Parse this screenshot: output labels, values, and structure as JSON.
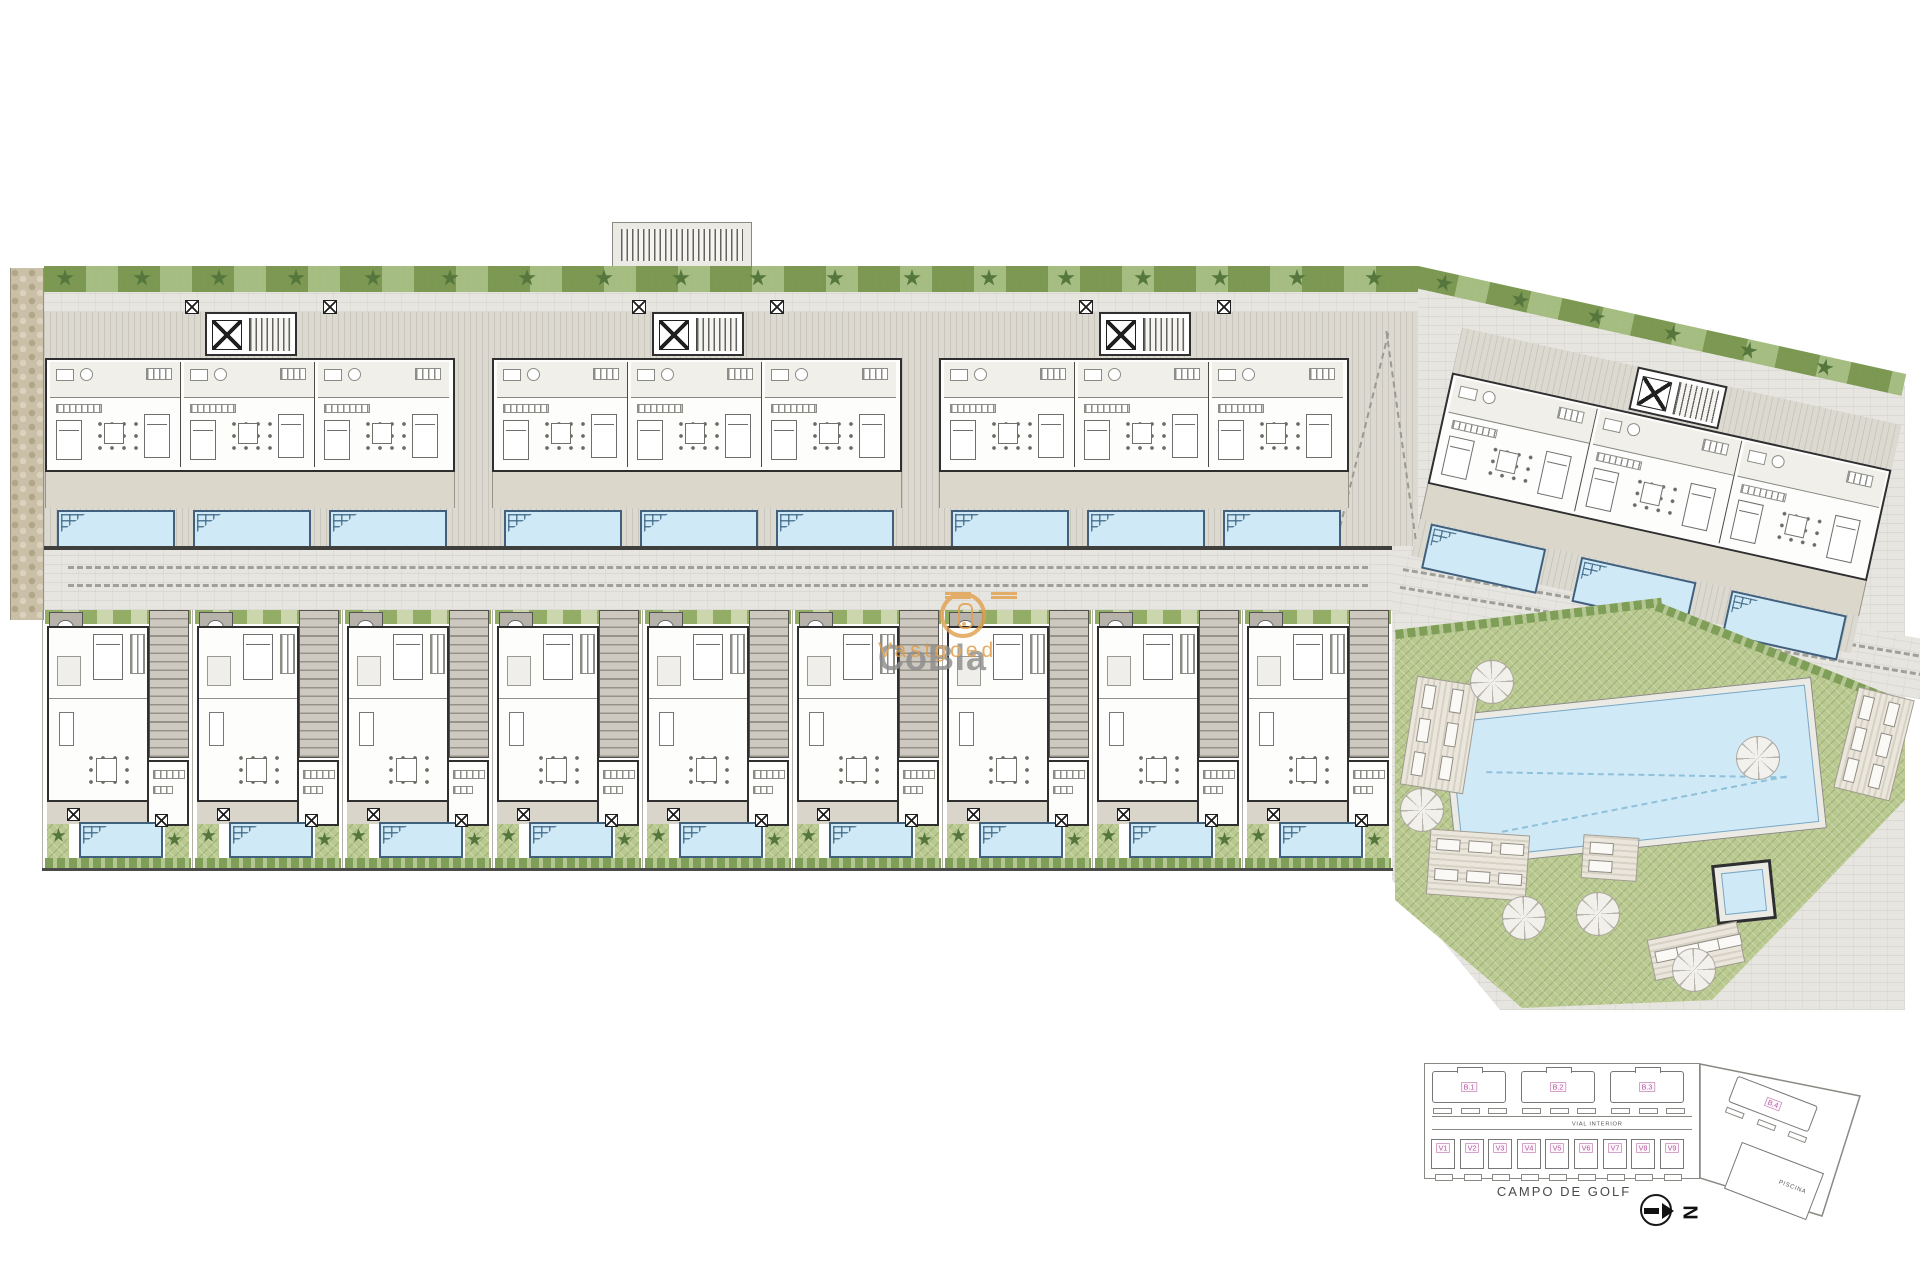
{
  "watermark": {
    "brand": "CoBla",
    "suffix": "Vastgoed",
    "brand_color": "#8d8d8d",
    "accent_color": "#e2a150"
  },
  "minimap": {
    "blocks_row": [
      "B.1",
      "B.2",
      "B.3"
    ],
    "block4_label": "B.4",
    "villas": [
      "V1",
      "V2",
      "V3",
      "V4",
      "V5",
      "V6",
      "V7",
      "V8",
      "V9"
    ],
    "road_label": "VIAL INTERIOR",
    "pool_label": "PISCINA",
    "golf_label": "CAMPO DE GOLF",
    "north_label": "N",
    "label_color": "#b457a0"
  },
  "site": {
    "apartment_blocks": 3,
    "units_per_block": 3,
    "pools_per_block": 3,
    "villa_count": 9,
    "palms_top": 18,
    "palms_wing": 6,
    "colors": {
      "pool_water": "#cfe9f7",
      "pool_border": "#41607c",
      "hedge_green": "#8fae66",
      "communal_green": "#b9c98f",
      "paving": "#e7e5e0",
      "terrace": "#d9d5ca",
      "wall": "#2f2f2f",
      "dirt_path": "#cabfa7"
    }
  }
}
